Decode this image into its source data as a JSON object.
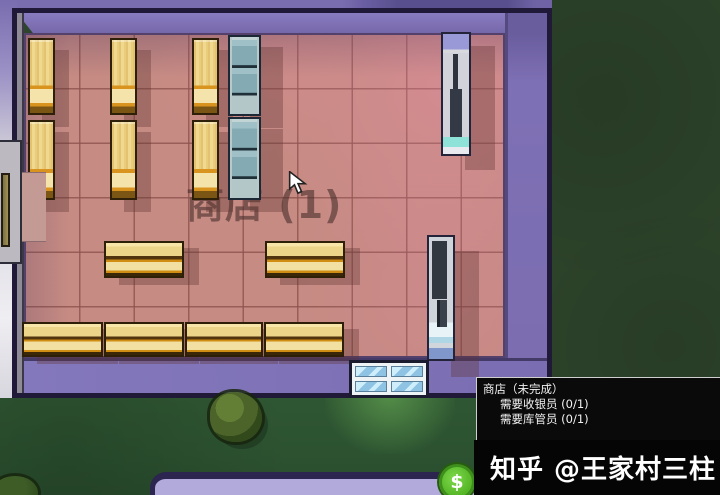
{
  "scene": {
    "shop_label": "商店 (1)",
    "money_symbol": "$"
  },
  "tooltip": {
    "title": "商店（未完成）",
    "requirements": [
      "需要收银员 (0/1)",
      "需要库管员 (0/1)"
    ]
  },
  "watermark": "知乎 @王家村三柱",
  "colors": {
    "wall_purple": "#7b6db0",
    "outline_navy": "#201a38",
    "floor_pink": "#c68b83",
    "grass_dark": "#2c4229",
    "shelf_wood": "#eed382",
    "shelf_orange": "#d8941f",
    "fridge_steel": "#84abb4",
    "door_glass": "#8fc3e4",
    "money_green": "#54b525",
    "tooltip_bg": "#0a0a0a"
  },
  "furniture": [
    {
      "type": "shelf-v",
      "x": 28,
      "y": 38,
      "w": 27,
      "h": 77
    },
    {
      "type": "shelf-v",
      "x": 110,
      "y": 38,
      "w": 27,
      "h": 77
    },
    {
      "type": "shelf-v",
      "x": 192,
      "y": 38,
      "w": 27,
      "h": 77
    },
    {
      "type": "shelf-v",
      "x": 28,
      "y": 120,
      "w": 27,
      "h": 80
    },
    {
      "type": "shelf-v",
      "x": 110,
      "y": 120,
      "w": 27,
      "h": 80
    },
    {
      "type": "shelf-v",
      "x": 192,
      "y": 120,
      "w": 27,
      "h": 80
    },
    {
      "type": "fridge",
      "x": 228,
      "y": 35,
      "w": 33,
      "h": 81
    },
    {
      "type": "fridge",
      "x": 228,
      "y": 117,
      "w": 33,
      "h": 83
    },
    {
      "type": "vending-top",
      "x": 441,
      "y": 32,
      "w": 30,
      "h": 124
    },
    {
      "type": "vending-bottom",
      "x": 427,
      "y": 235,
      "w": 28,
      "h": 126
    },
    {
      "type": "shelf-h",
      "x": 104,
      "y": 241,
      "w": 80,
      "h": 37
    },
    {
      "type": "shelf-h",
      "x": 265,
      "y": 241,
      "w": 80,
      "h": 37
    },
    {
      "type": "shelf-h",
      "x": 22,
      "y": 322,
      "w": 81,
      "h": 35
    },
    {
      "type": "shelf-h",
      "x": 104,
      "y": 322,
      "w": 80,
      "h": 35
    },
    {
      "type": "shelf-h",
      "x": 185,
      "y": 322,
      "w": 78,
      "h": 35
    },
    {
      "type": "shelf-h",
      "x": 264,
      "y": 322,
      "w": 80,
      "h": 35
    }
  ]
}
